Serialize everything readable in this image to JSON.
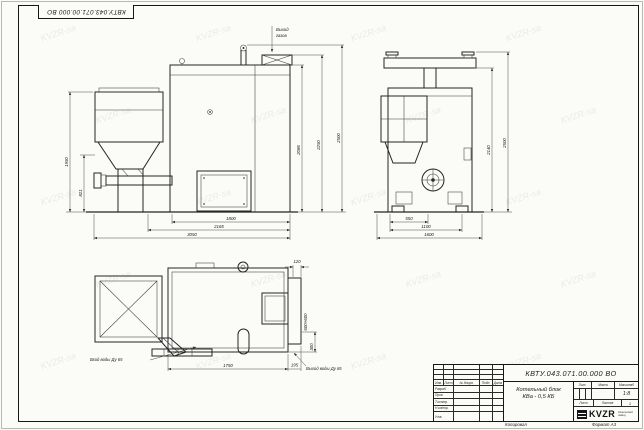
{
  "drawing": {
    "corner_stamp": "КВТУ.043.071.00.000 ВО",
    "watermark": "KVZR",
    "labels": {
      "gas_outlet_1": "Выход",
      "gas_outlet_2": "газов",
      "water_inlet": "Вход воды Ду 65",
      "water_outlet": "Выход воды Ду 65"
    },
    "dims": {
      "front_height": "1950",
      "front_feed_height": "821",
      "front_w_body": "1800",
      "front_w_mid": "2165",
      "front_w_total": "3050",
      "elev_h_body": "2086",
      "elev_h_duct": "2250",
      "elev_h_total": "2500",
      "side_w1": "550",
      "side_w2": "1100",
      "side_w3": "1600",
      "side_h_duct": "2140",
      "side_h_total": "2500",
      "plan_offset_top": "120",
      "plan_opening": "600×600",
      "plan_offset_right": "300",
      "plan_w_main": "1750",
      "plan_w_door": "195"
    }
  },
  "title_block": {
    "doc_number": "КВТУ.043.071.00.000 ВО",
    "product_name_1": "Котельный блок",
    "product_name_2": "КВа - 0,5 КБ",
    "cols": {
      "izm": "Изм.",
      "list": "Лист",
      "doc": "№ докум.",
      "sign": "Подп.",
      "date": "Дата"
    },
    "roles": [
      "Разраб.",
      "Пров.",
      "Т.контр.",
      "Н.контр.",
      "Утв."
    ],
    "header_lit": "Лит.",
    "header_mass": "Масса",
    "header_scale": "Масштаб",
    "scale_value": "1:8",
    "sheet_label": "Лист",
    "sheets_label": "Листов",
    "sheets_count": "1",
    "logo_text": "KVZR",
    "logo_caption_1": "Козельский",
    "logo_caption_2": "завод",
    "copied_label": "Копировал",
    "format_label": "Формат А3"
  }
}
